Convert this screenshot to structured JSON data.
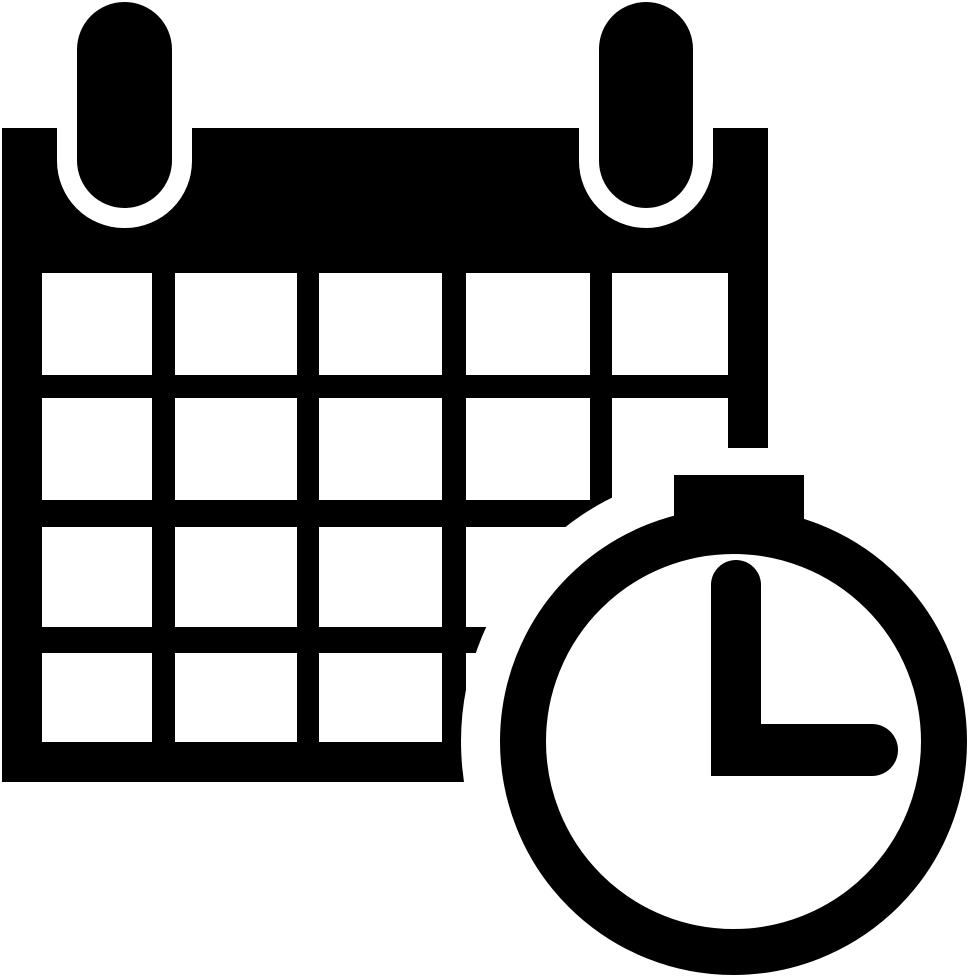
{
  "icon": {
    "title": "Calendar with clock",
    "type": "glyph-icon",
    "foreground_color": "#000000",
    "background_color": "#ffffff",
    "calendar": {
      "binding_rings": 2,
      "grid_columns": 5,
      "grid_rows": 4
    },
    "clock": {
      "time_shown": "3:00",
      "minute_hand": "pointing up",
      "hour_hand": "pointing right",
      "has_top_button": true
    }
  }
}
